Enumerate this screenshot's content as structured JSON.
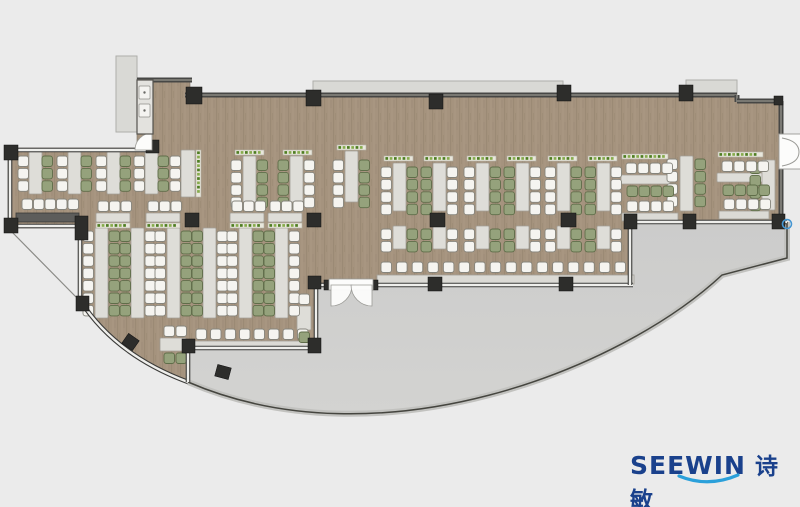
{
  "logo": {
    "latin": "SEEWIN",
    "cjk": "诗敏"
  },
  "colors": {
    "bg": "#ebebeb",
    "wood": "#a5937e",
    "woodDark": "#94826d",
    "woodLight": "#b3a28c",
    "terrace": "#d3d3d1",
    "terraceTop": "#cccccb",
    "rimBand": "#c2c2bf",
    "rimLine": "#45453f",
    "wallDark": "#474745",
    "wallCore": "#97958e",
    "glassDark": "#3b3b39",
    "glassCore": "#efefec",
    "column": "#2d2d2b",
    "table": "#deddd8",
    "tableStroke": "#a29f97",
    "counter": "#dbdad5",
    "counterDark": "#5d5d5b",
    "chairWhite": "#f5f4f0",
    "chairWhiteStroke": "#85847c",
    "chairGreen": "#95a27c",
    "chairGreenStroke": "#5f6d49",
    "plantBase": "#e9e7dc",
    "plantStroke": "#b5b3a6",
    "plantDark": "#4e7d22",
    "plantLight": "#86ab4d",
    "canopy": "#d9d9d5",
    "canopyStroke": "#aeaeaa",
    "door": "#fcfcfb",
    "doorStroke": "#9a9a96",
    "navy": "#1a418c",
    "swoosh": "#2ba0da",
    "marker": "#4596d2",
    "shaft": "#e3e2de",
    "thinLine": "#8a8a86"
  },
  "plan": {
    "interior_path": "M137,80 L190,80 L190,95 L737,95 L737,101 L781,101 L781,220 L630,220 L630,285 L316,285 L316,348 L188,348 L188,382 Q115,355 80,300 L80,228 L8,228 L8,148 L137,148 Z",
    "terrace_path": "M318,285 L630,285 L630,222 L787,222 L787,258 L722,275 C620,370 380,465 188,382 L188,348 L316,348 L316,285 Z",
    "terrace_rim": "M787,222 L787,258 L722,275 C620,370 380,465 188,382",
    "canopies": [
      [
        313,
        81,
        250,
        15
      ],
      [
        686,
        80,
        51,
        17
      ],
      [
        116,
        56,
        21,
        76
      ]
    ],
    "glass_walls": [
      "M8,150 L150,150",
      "M10,148 L10,228",
      "M8,226 L80,226",
      "M80,226 L80,302",
      "M80,300 Q115,355 188,382",
      "M188,348 L188,382",
      "M188,348 L316,348",
      "M316,285 L316,348",
      "M316,285 L330,285",
      "M372,285 L633,285",
      "M630,222 L630,285",
      "M630,222 L787,222"
    ],
    "dark_walls": [
      "M137,80 L192,80",
      "M185,95 L737,95",
      "M737,95 L737,102",
      "M737,101 L781,101",
      "M781,101 L781,137",
      "M781,167 L781,222"
    ],
    "thin_lines": [
      "M10,230 L76,297"
    ],
    "tables": [
      [
        29,
        152,
        13,
        42
      ],
      [
        68,
        152,
        13,
        42
      ],
      [
        107,
        152,
        13,
        42
      ],
      [
        145,
        152,
        13,
        42
      ],
      [
        181,
        150,
        14,
        47
      ],
      [
        243,
        156,
        13,
        46
      ],
      [
        290,
        156,
        13,
        46
      ],
      [
        345,
        151,
        13,
        51
      ],
      [
        95,
        228,
        13,
        90
      ],
      [
        131,
        228,
        13,
        90
      ],
      [
        167,
        228,
        13,
        90
      ],
      [
        203,
        228,
        13,
        90
      ],
      [
        239,
        228,
        13,
        90
      ],
      [
        275,
        228,
        13,
        90
      ],
      [
        96,
        213,
        34,
        9
      ],
      [
        146,
        213,
        34,
        9
      ],
      [
        230,
        213,
        34,
        9
      ],
      [
        268,
        213,
        34,
        9
      ],
      [
        393,
        163,
        13,
        48
      ],
      [
        433,
        163,
        13,
        48
      ],
      [
        476,
        163,
        13,
        48
      ],
      [
        516,
        163,
        13,
        48
      ],
      [
        557,
        163,
        13,
        48
      ],
      [
        597,
        163,
        13,
        48
      ],
      [
        393,
        226,
        13,
        23
      ],
      [
        433,
        226,
        13,
        23
      ],
      [
        476,
        226,
        13,
        23
      ],
      [
        516,
        226,
        13,
        23
      ],
      [
        557,
        226,
        13,
        23
      ],
      [
        597,
        226,
        13,
        23
      ],
      [
        621,
        175,
        49,
        9
      ],
      [
        717,
        173,
        48,
        9
      ],
      [
        680,
        156,
        13,
        55
      ],
      [
        762,
        160,
        13,
        50
      ],
      [
        160,
        338,
        26,
        13
      ],
      [
        297,
        306,
        14,
        24
      ]
    ],
    "counters": [
      [
        377,
        275,
        257,
        9
      ],
      [
        191,
        341,
        122,
        8
      ],
      [
        622,
        213,
        56,
        8
      ],
      [
        719,
        211,
        50,
        8
      ]
    ],
    "dark_counters": [
      [
        16,
        213,
        63,
        9
      ]
    ],
    "chair_cols": [
      [
        18,
        156,
        3,
        "w"
      ],
      [
        42,
        156,
        3,
        "g"
      ],
      [
        57,
        156,
        3,
        "w"
      ],
      [
        81,
        156,
        3,
        "g"
      ],
      [
        96,
        156,
        3,
        "w"
      ],
      [
        120,
        156,
        3,
        "g"
      ],
      [
        134,
        156,
        3,
        "w"
      ],
      [
        158,
        156,
        3,
        "g"
      ],
      [
        170,
        156,
        3,
        "w"
      ],
      [
        231,
        160,
        4,
        "w"
      ],
      [
        257,
        160,
        4,
        "g"
      ],
      [
        278,
        160,
        4,
        "g"
      ],
      [
        304,
        160,
        4,
        "w"
      ],
      [
        333,
        160,
        4,
        "w"
      ],
      [
        359,
        160,
        4,
        "g"
      ],
      [
        83,
        231,
        7,
        "w"
      ],
      [
        109,
        231,
        7,
        "g"
      ],
      [
        120,
        231,
        7,
        "g"
      ],
      [
        145,
        231,
        7,
        "w"
      ],
      [
        155,
        231,
        7,
        "w"
      ],
      [
        181,
        231,
        7,
        "g"
      ],
      [
        192,
        231,
        7,
        "g"
      ],
      [
        217,
        231,
        7,
        "w"
      ],
      [
        227,
        231,
        7,
        "w"
      ],
      [
        253,
        231,
        7,
        "g"
      ],
      [
        264,
        231,
        7,
        "g"
      ],
      [
        289,
        231,
        7,
        "w"
      ],
      [
        381,
        167,
        4,
        "w"
      ],
      [
        407,
        167,
        4,
        "g"
      ],
      [
        421,
        167,
        4,
        "g"
      ],
      [
        447,
        167,
        4,
        "w"
      ],
      [
        464,
        167,
        4,
        "w"
      ],
      [
        490,
        167,
        4,
        "g"
      ],
      [
        504,
        167,
        4,
        "g"
      ],
      [
        530,
        167,
        4,
        "w"
      ],
      [
        545,
        167,
        4,
        "w"
      ],
      [
        571,
        167,
        4,
        "g"
      ],
      [
        585,
        167,
        4,
        "g"
      ],
      [
        611,
        167,
        4,
        "w"
      ],
      [
        381,
        229,
        2,
        "w"
      ],
      [
        407,
        229,
        2,
        "g"
      ],
      [
        421,
        229,
        2,
        "g"
      ],
      [
        447,
        229,
        2,
        "w"
      ],
      [
        464,
        229,
        2,
        "w"
      ],
      [
        490,
        229,
        2,
        "g"
      ],
      [
        504,
        229,
        2,
        "g"
      ],
      [
        530,
        229,
        2,
        "w"
      ],
      [
        545,
        229,
        2,
        "w"
      ],
      [
        571,
        229,
        2,
        "g"
      ],
      [
        585,
        229,
        2,
        "g"
      ],
      [
        611,
        229,
        2,
        "w"
      ],
      [
        667,
        159,
        4,
        "w"
      ],
      [
        695,
        159,
        4,
        "g"
      ],
      [
        750,
        163,
        4,
        "g"
      ]
    ],
    "chair_rows": [
      [
        22,
        199,
        5,
        "w",
        11.5
      ],
      [
        98,
        201,
        3,
        "w",
        11.5
      ],
      [
        148,
        201,
        3,
        "w",
        11.5
      ],
      [
        232,
        201,
        3,
        "w",
        11.5
      ],
      [
        270,
        201,
        3,
        "w",
        11.5
      ],
      [
        381,
        262,
        16,
        "w",
        15.6
      ],
      [
        196,
        329,
        8,
        "w",
        14.5
      ],
      [
        626,
        163,
        4,
        "w",
        12
      ],
      [
        627,
        186,
        4,
        "g",
        12
      ],
      [
        627,
        201,
        4,
        "w",
        12
      ],
      [
        722,
        161,
        4,
        "w",
        12
      ],
      [
        723,
        185,
        4,
        "g",
        12
      ],
      [
        724,
        199,
        4,
        "w",
        12
      ],
      [
        164,
        326,
        2,
        "w",
        12
      ],
      [
        164,
        353,
        2,
        "g",
        12
      ],
      [
        299,
        294,
        1,
        "w",
        12
      ],
      [
        299,
        332,
        1,
        "g",
        12
      ]
    ],
    "plant_strips": [
      [
        384,
        156,
        29,
        5,
        "h"
      ],
      [
        424,
        156,
        29,
        5,
        "h"
      ],
      [
        467,
        156,
        29,
        5,
        "h"
      ],
      [
        507,
        156,
        29,
        5,
        "h"
      ],
      [
        548,
        156,
        29,
        5,
        "h"
      ],
      [
        588,
        156,
        29,
        5,
        "h"
      ],
      [
        622,
        154,
        46,
        5,
        "h"
      ],
      [
        718,
        152,
        45,
        5,
        "h"
      ],
      [
        235,
        150,
        29,
        5,
        "h"
      ],
      [
        283,
        150,
        29,
        5,
        "h"
      ],
      [
        337,
        145,
        29,
        5,
        "h"
      ],
      [
        96,
        223,
        34,
        5,
        "h"
      ],
      [
        146,
        223,
        34,
        5,
        "h"
      ],
      [
        230,
        223,
        34,
        5,
        "h"
      ],
      [
        268,
        223,
        34,
        5,
        "h"
      ],
      [
        196,
        150,
        5,
        47,
        "v"
      ]
    ],
    "columns": [
      [
        186,
        87,
        16,
        17,
        0
      ],
      [
        306,
        90,
        15,
        16,
        0
      ],
      [
        429,
        94,
        14,
        15,
        0
      ],
      [
        557,
        85,
        14,
        16,
        0
      ],
      [
        679,
        85,
        14,
        16,
        0
      ],
      [
        146,
        140,
        13,
        13,
        0
      ],
      [
        4,
        145,
        14,
        15,
        0
      ],
      [
        4,
        218,
        14,
        15,
        0
      ],
      [
        75,
        216,
        13,
        24,
        0
      ],
      [
        76,
        296,
        13,
        15,
        0
      ],
      [
        124,
        336,
        13,
        12,
        35
      ],
      [
        216,
        366,
        14,
        12,
        15
      ],
      [
        182,
        339,
        13,
        14,
        0
      ],
      [
        308,
        338,
        13,
        15,
        0
      ],
      [
        308,
        276,
        13,
        13,
        0
      ],
      [
        428,
        277,
        14,
        14,
        0
      ],
      [
        559,
        277,
        14,
        14,
        0
      ],
      [
        624,
        214,
        13,
        15,
        0
      ],
      [
        683,
        214,
        13,
        15,
        0
      ],
      [
        772,
        214,
        13,
        15,
        0
      ],
      [
        185,
        213,
        14,
        14,
        0
      ],
      [
        307,
        213,
        14,
        14,
        0
      ],
      [
        430,
        213,
        15,
        14,
        0
      ],
      [
        561,
        213,
        15,
        14,
        0
      ],
      [
        774,
        96,
        9,
        9,
        0
      ],
      [
        324,
        280,
        7,
        10,
        0
      ],
      [
        371,
        280,
        7,
        10,
        0
      ]
    ],
    "doors": {
      "terrace_rect": [
        329,
        279,
        44,
        11
      ],
      "terrace_leaves": [
        "M331,285 L352,285 A21,21 0 0 1 331,306 Z",
        "M372,285 L351,285 A21,21 0 0 0 372,306 Z"
      ],
      "right_rect": [
        779,
        134,
        22,
        35
      ],
      "right_arcs": [
        "M782,138 Q799,141 799,152",
        "M782,166 Q799,163 799,152"
      ],
      "nw_wedge": "M152,133 A17,17 0 0 0 135,150 L152,150 Z"
    },
    "shaft": {
      "rect": [
        137,
        80,
        16,
        54
      ],
      "panels": [
        [
          139,
          86,
          11,
          13
        ],
        [
          139,
          104,
          11,
          13
        ]
      ],
      "dots": [
        [
          144.5,
          92.5
        ],
        [
          144.5,
          110.5
        ]
      ]
    },
    "marker": [
      787,
      224,
      4.5
    ]
  }
}
